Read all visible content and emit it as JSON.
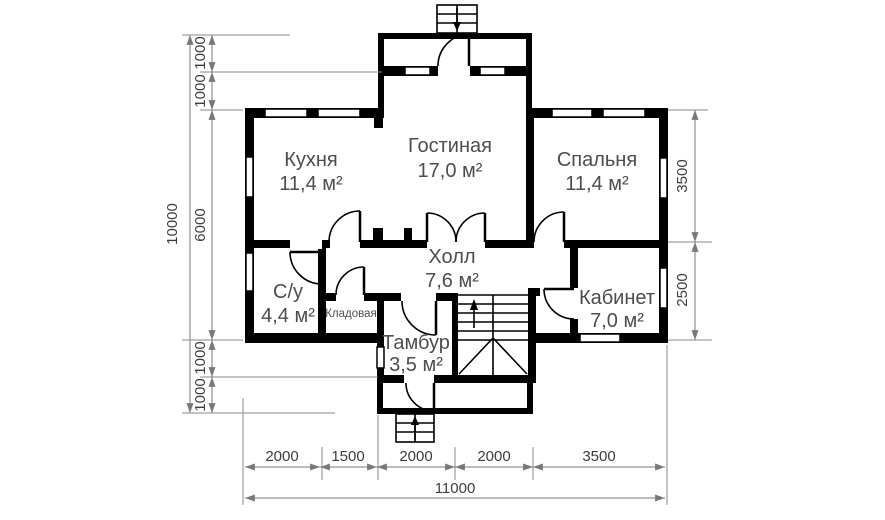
{
  "plan": {
    "colors": {
      "background": "#ffffff",
      "wall": "#000000",
      "dimension_line": "#787878",
      "dimension_text": "#3d3d3d",
      "room_label": "#4d4d4d"
    },
    "rooms": {
      "kitchen": {
        "name": "Кухня",
        "area": "11,4 м²"
      },
      "living": {
        "name": "Гостиная",
        "area": "17,0 м²"
      },
      "bedroom": {
        "name": "Спальня",
        "area": "11,4 м²"
      },
      "hall": {
        "name": "Холл",
        "area": "7,6 м²"
      },
      "bathroom": {
        "name": "С/у",
        "area": "4,4 м²"
      },
      "pantry": {
        "name": "Кладовая"
      },
      "vestibule": {
        "name": "Тамбур",
        "area": "3,5 м²"
      },
      "study": {
        "name": "Кабинет",
        "area": "7,0 м²"
      }
    },
    "dimensions": {
      "left_total": "10000",
      "left_segments": [
        "1000",
        "1000",
        "6000",
        "1000",
        "1000"
      ],
      "right_segments": [
        "3500",
        "2500"
      ],
      "bottom_segments": [
        "2000",
        "1500",
        "2000",
        "2000",
        "3500"
      ],
      "bottom_total": "11000"
    }
  }
}
